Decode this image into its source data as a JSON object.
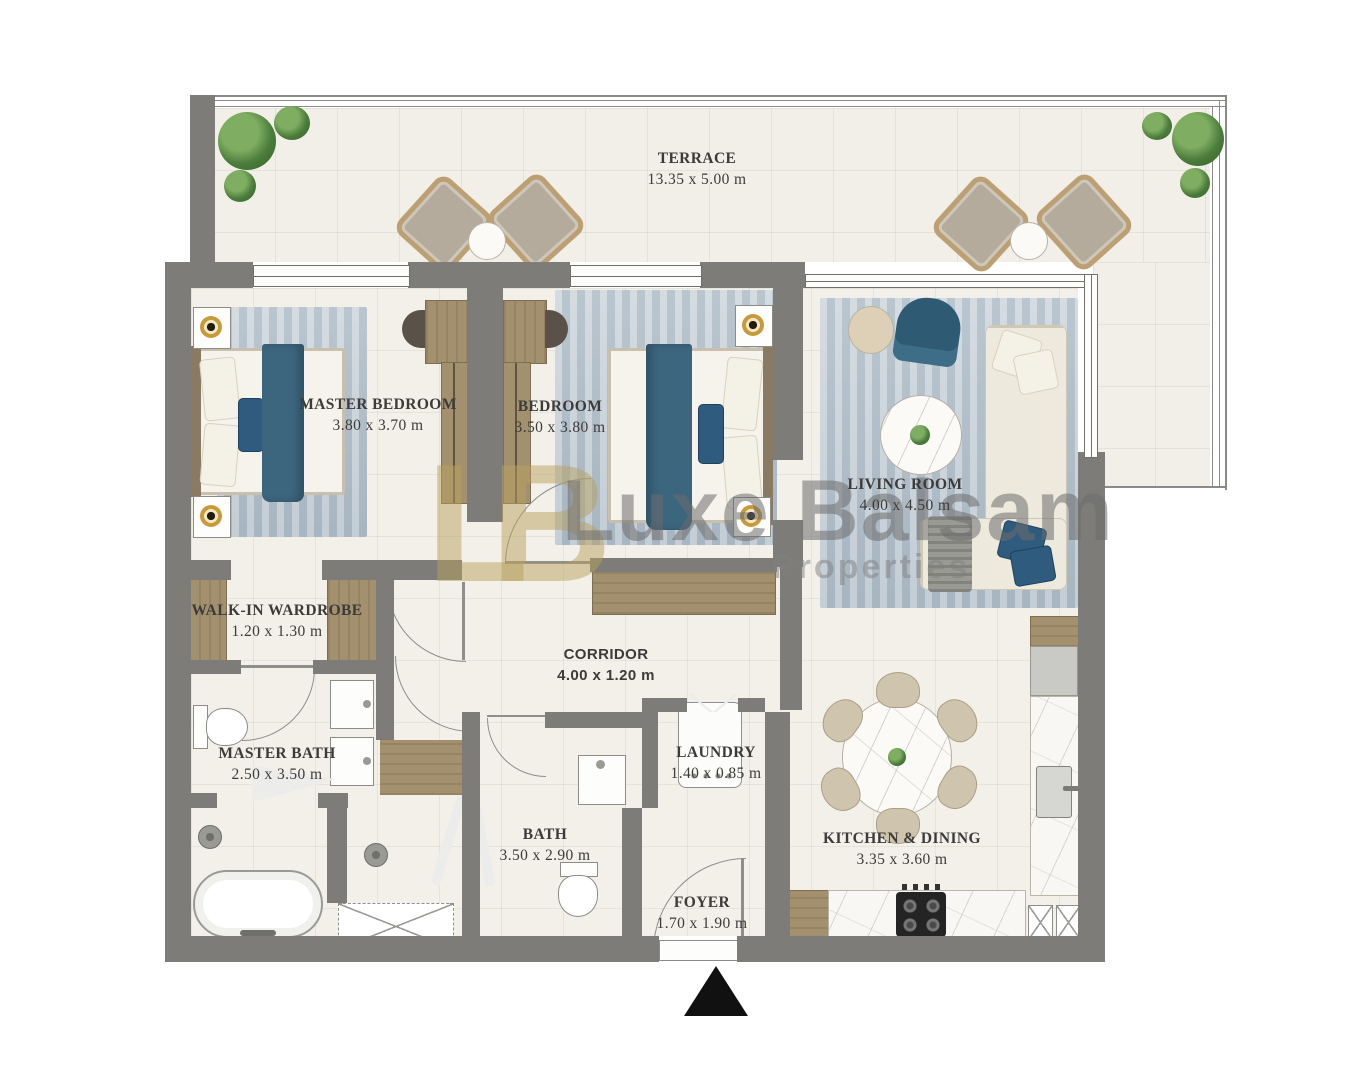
{
  "plan_title": "Apartment floor plan",
  "rooms": [
    {
      "name": "TERRACE",
      "dims": "13.35 x 5.00 m"
    },
    {
      "name": "MASTER BEDROOM",
      "dims": "3.80 x 3.70 m"
    },
    {
      "name": "BEDROOM",
      "dims": "3.50 x 3.80 m"
    },
    {
      "name": "LIVING ROOM",
      "dims": "4.00 x 4.50 m"
    },
    {
      "name": "WALK-IN WARDROBE",
      "dims": "1.20 x 1.30 m"
    },
    {
      "name": "MASTER BATH",
      "dims": "2.50 x 3.50 m"
    },
    {
      "name": "CORRIDOR",
      "dims": "4.00 x 1.20 m"
    },
    {
      "name": "LAUNDRY",
      "dims": "1.40 x 0.85 m"
    },
    {
      "name": "BATH",
      "dims": "3.50 x 2.90 m"
    },
    {
      "name": "KITCHEN & DINING",
      "dims": "3.35 x 3.60 m"
    },
    {
      "name": "FOYER",
      "dims": "1.70 x 1.90 m"
    }
  ],
  "watermark": {
    "monogram": "LB",
    "brand": "Luxe Balsam",
    "tagline": "Properties"
  },
  "entrance_marker": "▲",
  "colors": {
    "wall": "#7d7c78",
    "floor": "#f2f0e9",
    "rug": "#b9c5cf",
    "accent_teal": "#38637e",
    "wood": "#a3906f",
    "watermark_gold": "#bba45f",
    "watermark_gray": "#7a7a7a"
  }
}
